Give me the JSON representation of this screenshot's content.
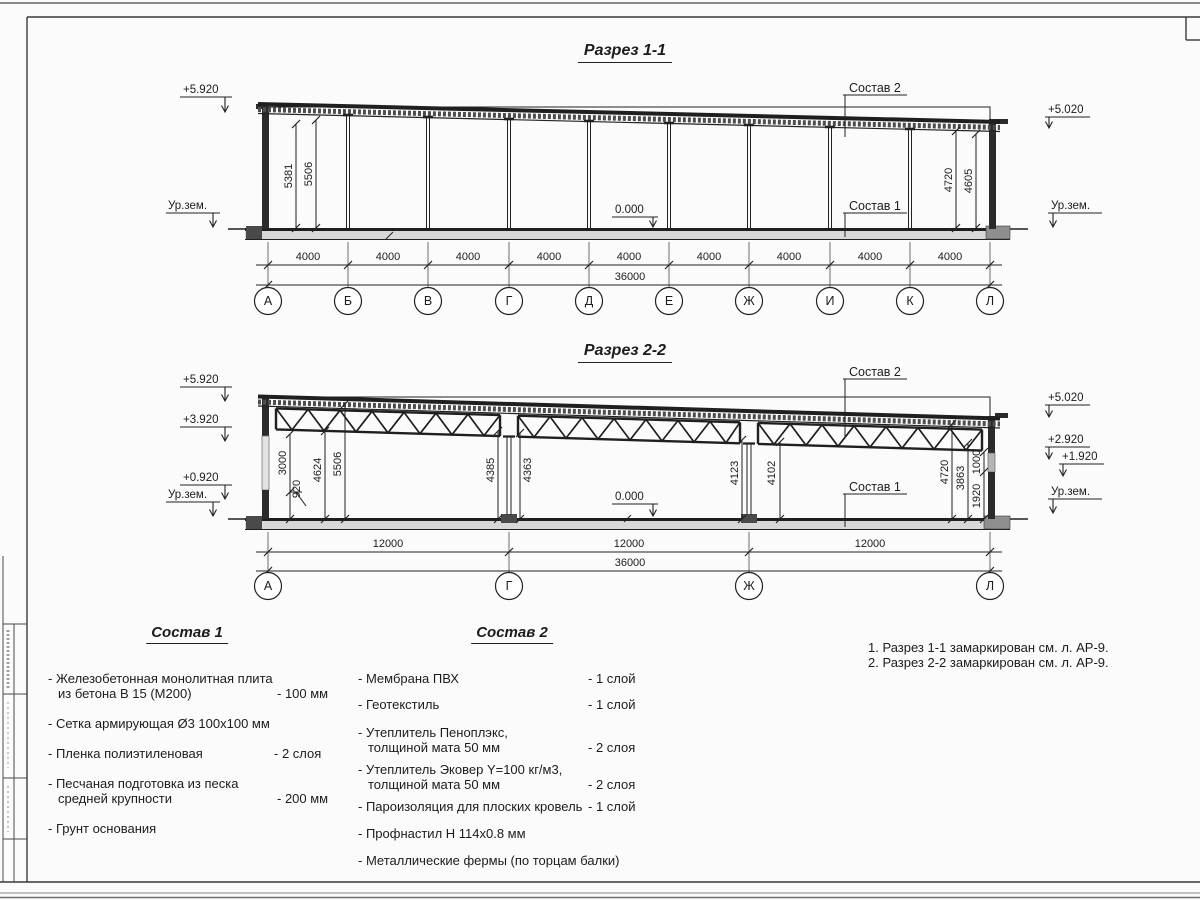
{
  "s1": {
    "title": "Разрез 1-1",
    "elev_left_top": "+5.920",
    "elev_left_ground": "Ур.зем.",
    "elev_right_top": "+5.020",
    "elev_right_ground": "Ур.зем.",
    "zero": "0.000",
    "label_sostav2": "Состав 2",
    "label_sostav1": "Состав 1",
    "dl1": "5381",
    "dl2": "5506",
    "dr1": "4720",
    "dr2": "4605",
    "bays": [
      "4000",
      "4000",
      "4000",
      "4000",
      "4000",
      "4000",
      "4000",
      "4000",
      "4000"
    ],
    "total": "36000",
    "axes": [
      "А",
      "Б",
      "В",
      "Г",
      "Д",
      "Е",
      "Ж",
      "И",
      "К",
      "Л"
    ]
  },
  "s2": {
    "title": "Разрез 2-2",
    "el1": "+5.920",
    "el2": "+3.920",
    "el3": "+0.920",
    "elev_left_ground": "Ур.зем.",
    "er1": "+5.020",
    "er2": "+2.920",
    "er3": "+1.920",
    "elev_right_ground": "Ур.зем.",
    "zero": "0.000",
    "label_sostav2": "Состав 2",
    "label_sostav1": "Состав 1",
    "dl1": "3000",
    "dl2": "920",
    "dl3": "4624",
    "dl4": "5506",
    "dg1": "4385",
    "dg2": "4363",
    "dj1": "4123",
    "dj2": "4102",
    "dr1": "4720",
    "dr2": "3863",
    "dr3": "1000",
    "dr4": "1920",
    "bays": [
      "12000",
      "12000",
      "12000"
    ],
    "total": "36000",
    "axes": [
      "А",
      "Г",
      "Ж",
      "Л"
    ]
  },
  "c1": {
    "header": "Состав 1",
    "i1a": "- Железобетонная монолитная плита",
    "i1b": "из бетона В 15 (М200)",
    "i1v": "- 100 мм",
    "i2": "- Сетка армирующая Ø3 100х100 мм",
    "i3": "- Пленка полиэтиленовая",
    "i3v": "-  2 слоя",
    "i4a": "- Песчаная подготовка из песка",
    "i4b": "средней крупности",
    "i4v": "- 200 мм",
    "i5": "- Грунт основания"
  },
  "c2": {
    "header": "Состав 2",
    "i1": "- Мембрана ПВХ",
    "i1v": "- 1 слой",
    "i2": "- Геотекстиль",
    "i2v": "- 1 слой",
    "i3a": "- Утеплитель Пеноплэкс,",
    "i3b": "толщиной мата 50 мм",
    "i3v": "- 2 слоя",
    "i4a": "- Утеплитель Эковер Y=100 кг/м3,",
    "i4b": "толщиной мата 50 мм",
    "i4v": "- 2 слоя",
    "i5": "- Пароизоляция для плоских кровель",
    "i5v": "- 1 слой",
    "i6": "- Профнастил Н 114х0.8 мм",
    "i7": "- Металлические фермы (по торцам балки)"
  },
  "notes": [
    "1. Разрез 1-1 замаркирован см. л. АР-9.",
    "2. Разрез 2-2 замаркирован см. л. АР-9."
  ]
}
